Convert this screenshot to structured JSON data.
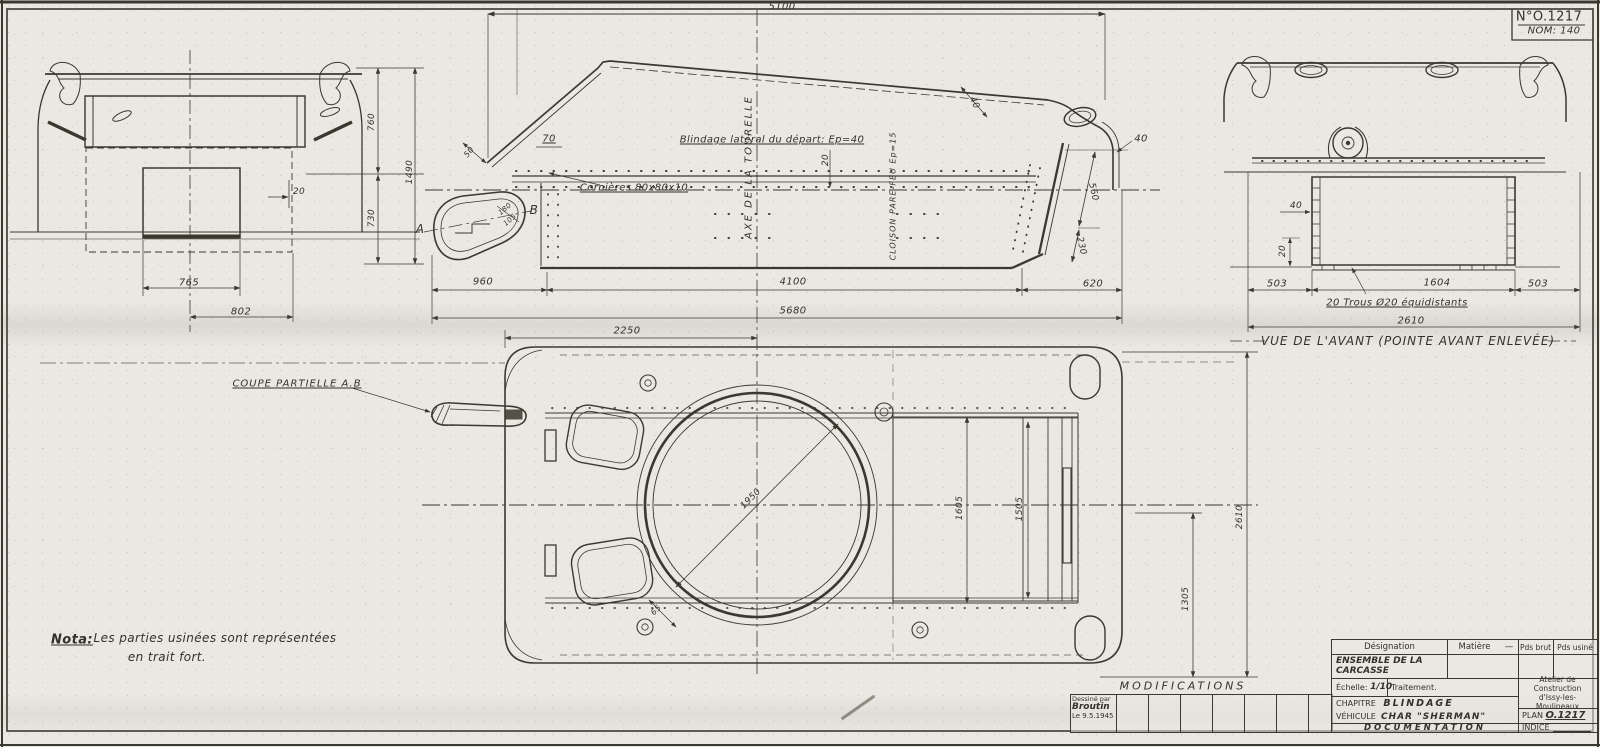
{
  "ref_box": {
    "plan_no": "N°O.1217",
    "nom": "NOM: 140"
  },
  "side_view": {
    "dim_5100": "5100",
    "dim_70": "70",
    "dim_50": "50",
    "label_blindage": "Blindage latéral du départ: Ep=40",
    "label_cornieres": "Cornières 80x80x10",
    "axis_label": "AXE  DE  LA  TOURELLE",
    "dim_20_axis": "20",
    "cloison_label": "CLOISON  PARE-FEU  Ep=15",
    "dim_40_deck": "40",
    "dim_40_rear": "40",
    "dim_560": "560",
    "dim_230": "230",
    "dim_620": "620",
    "dim_960": "960",
    "dim_4100": "4100",
    "dim_5680": "5680",
    "dim_2250": "2250",
    "section_a": "A",
    "section_b": "B",
    "dim_180": "180",
    "dim_105": "105"
  },
  "left_view": {
    "dim_20": "20",
    "dim_760": "760",
    "dim_1490": "1490",
    "dim_730": "730",
    "dim_765": "765",
    "dim_802": "802"
  },
  "front_view": {
    "dim_40": "40",
    "dim_20": "20",
    "dim_503_left": "503",
    "dim_1604": "1604",
    "dim_503_right": "503",
    "dim_2610": "2610",
    "holes_note": "20 Trous Ø20 équidistants",
    "caption": "VUE DE L'AVANT (POINTE AVANT ENLEVÉE)"
  },
  "plan_view": {
    "coupe_label": "COUPE  PARTIELLE A.B",
    "dim_1950": "1950",
    "dim_65": "65",
    "dim_1605": "1605",
    "dim_1505": "1505",
    "dim_1305": "1305",
    "dim_2610": "2610"
  },
  "nota": {
    "label": "Nota:",
    "line1": "Les parties usinées sont représentées",
    "line2": "en trait fort."
  },
  "modifications": {
    "header": "MODIFICATIONS",
    "drawn_by_label": "Dessiné par",
    "drawn_by_name": "Broutin",
    "drawn_date": "Le 9.5.1945"
  },
  "title_block": {
    "designation_header": "Désignation",
    "matiere_header": "Matière",
    "matiere_value": "—",
    "pds_brut": "Pds brut",
    "pds_usine": "Pds usiné",
    "designation_value": "ENSEMBLE DE LA CARCASSE",
    "echelle_label": "Échelle:",
    "echelle_value": "1/10",
    "traitement_label": "Traitement.",
    "atelier_line1": "Atelier de",
    "atelier_line2": "Construction",
    "atelier_line3": "d'Issy-les-Moulineaux",
    "chapitre_label": "CHAPITRE",
    "chapitre_value": "BLINDAGE",
    "vehicule_label": "VÉHICULE",
    "vehicule_value": "CHAR \"SHERMAN\"",
    "documentation": "DOCUMENTATION",
    "plan_label": "PLAN",
    "plan_value": "O.1217",
    "indice_label": "INDICE"
  },
  "colors": {
    "paper": "#e9e8e1",
    "ink": "#3a382f"
  }
}
